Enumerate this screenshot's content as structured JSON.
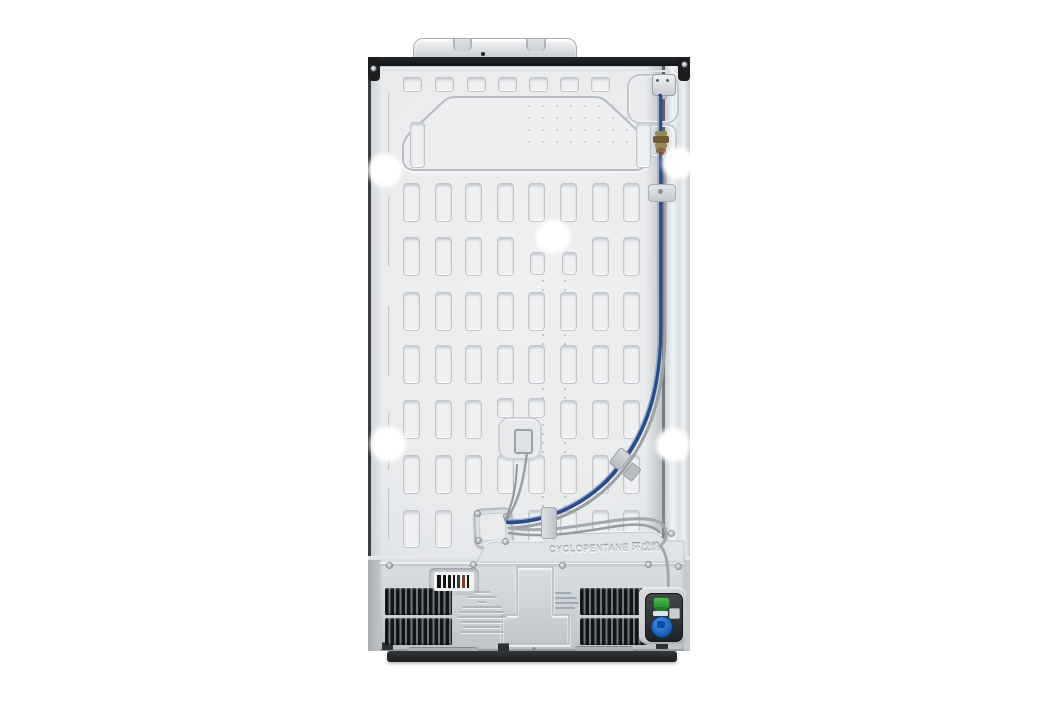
{
  "scene": {
    "type": "product-photo",
    "subject": "rear view of a stainless refrigerator back panel",
    "background_color": "#ffffff"
  },
  "embossed_text": {
    "refrigerant_label": "CYCLOPENTANE 环戊烷"
  },
  "colors": {
    "body_panel": "#e9ebed",
    "top_rail": "#17191b",
    "water_line_blue": "#2b4c86",
    "condenser_tube_gray": "#9aa0a6",
    "vent_grille_dark": "#17181a",
    "valve_cap_green": "#35a33a",
    "valve_fitting_blue": "#1f6fd2",
    "brass_connector": "#6e5a36",
    "base_plinth": "#232629"
  }
}
